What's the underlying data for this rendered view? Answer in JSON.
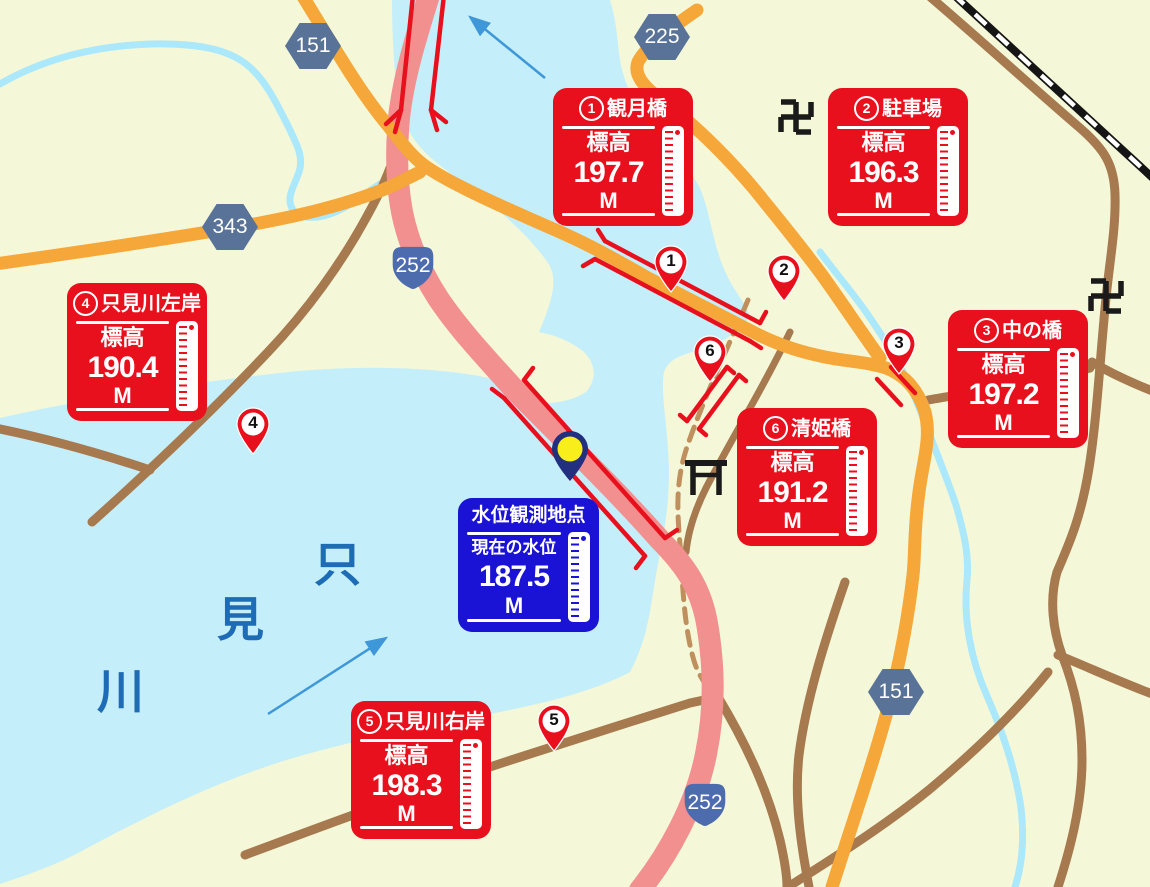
{
  "colors": {
    "background": "#f5f8d8",
    "water": "#c4eefa",
    "stream": "#ace8fb",
    "road_orange": "#f6a73a",
    "road_brown": "#a6794f",
    "trail_dashed_brown": "#c08f5e",
    "highway_pink": "#f28f8f",
    "signal_red": "#e8101d",
    "station_blue": "#1a12d4",
    "badge_hexagon_blue": "#587397",
    "badge_route_blue": "#4d6cae",
    "river_label_blue": "#1e6cb5",
    "flow_arrow_blue": "#3e97d8",
    "pin_navy": "#22307f",
    "pin_yellow": "#f8ee1b",
    "railway_black": "#151515"
  },
  "river_label": {
    "name": "只見川",
    "chars": [
      "只",
      "見",
      "川"
    ]
  },
  "station": {
    "title": "水位観測地点",
    "label": "現在の水位",
    "value": "187.5",
    "unit": "M"
  },
  "markers": [
    {
      "no": "1",
      "title": "観月橋",
      "label": "標高",
      "value": "197.7",
      "unit": "M"
    },
    {
      "no": "2",
      "title": "駐車場",
      "label": "標高",
      "value": "196.3",
      "unit": "M"
    },
    {
      "no": "3",
      "title": "中の橋",
      "label": "標高",
      "value": "197.2",
      "unit": "M"
    },
    {
      "no": "4",
      "title": "只見川左岸",
      "label": "標高",
      "value": "190.4",
      "unit": "M"
    },
    {
      "no": "5",
      "title": "只見川右岸",
      "label": "標高",
      "value": "198.3",
      "unit": "M"
    },
    {
      "no": "6",
      "title": "清姫橋",
      "label": "標高",
      "value": "191.2",
      "unit": "M"
    }
  ],
  "route_badges": [
    {
      "number": "151",
      "shape": "hexagon"
    },
    {
      "number": "225",
      "shape": "hexagon"
    },
    {
      "number": "343",
      "shape": "hexagon"
    },
    {
      "number": "252",
      "shape": "route-shield"
    },
    {
      "number": "252",
      "shape": "route-shield"
    },
    {
      "number": "151",
      "shape": "hexagon"
    }
  ],
  "map_symbols": {
    "temple": "卍",
    "temple_count": "2",
    "torii": "torii-gate",
    "railway": "railway-line",
    "flow_arrow_count": "2"
  }
}
